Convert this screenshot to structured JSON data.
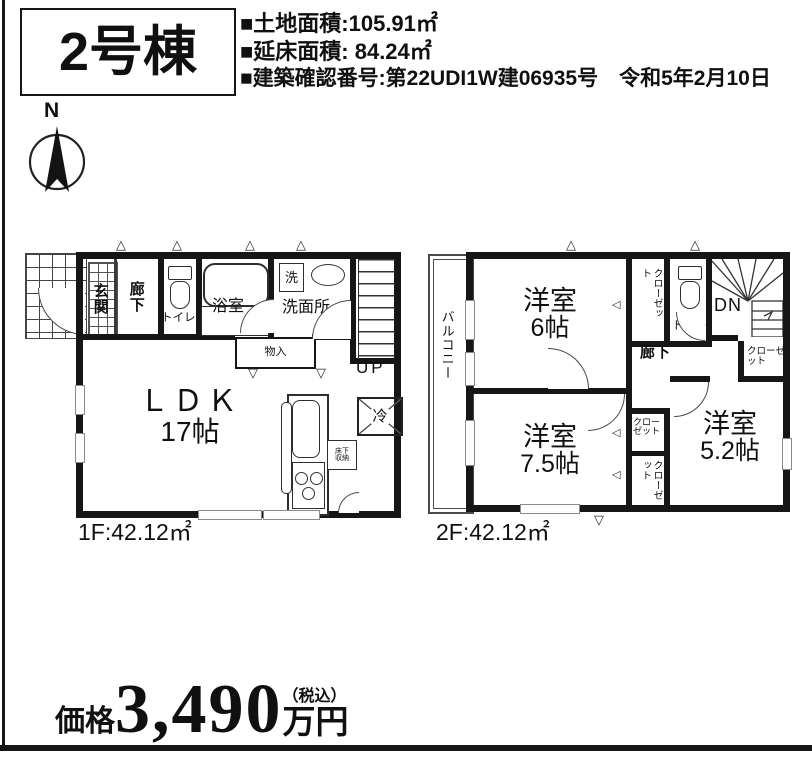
{
  "header": {
    "unit_label": "2号棟",
    "specs": [
      "■土地面積:105.91㎡",
      "■延床面積: 84.24㎡",
      "■建築確認番号:第22UDI1W建06935号　令和5年2月10日"
    ]
  },
  "compass": {
    "label": "N"
  },
  "floor1": {
    "area_label": "1F:42.12㎡",
    "ldk": {
      "name": "ＬＤＫ",
      "size": "17帖"
    },
    "genkan": "玄関",
    "hallway": "廊下",
    "toilet": "トイレ",
    "bath": "浴室",
    "washroom": "洗面所",
    "washer": "洗",
    "storage": "物入",
    "stairs_label": "UP",
    "fridge": "冷",
    "floor_storage": "床下収納"
  },
  "floor2": {
    "area_label": "2F:42.12㎡",
    "balcony": "バルコニー",
    "room6": {
      "name": "洋室",
      "size": "6帖"
    },
    "room75": {
      "name": "洋室",
      "size": "7.5帖"
    },
    "room52": {
      "name": "洋室",
      "size": "5.2帖"
    },
    "closet_north": "クローゼット",
    "closet_east": "クローゼット",
    "closet_mid": "クローゼット",
    "closet_south": "クローゼット",
    "toilet": "トイレ",
    "hallway": "廊下",
    "stairs_label": "DN"
  },
  "price": {
    "prefix": "価格",
    "amount": "3,490",
    "tax_note": "（税込）",
    "unit": "万円"
  },
  "icons": {
    "tri_up": "△",
    "tri_down": "▽",
    "tri_left": "◁"
  }
}
